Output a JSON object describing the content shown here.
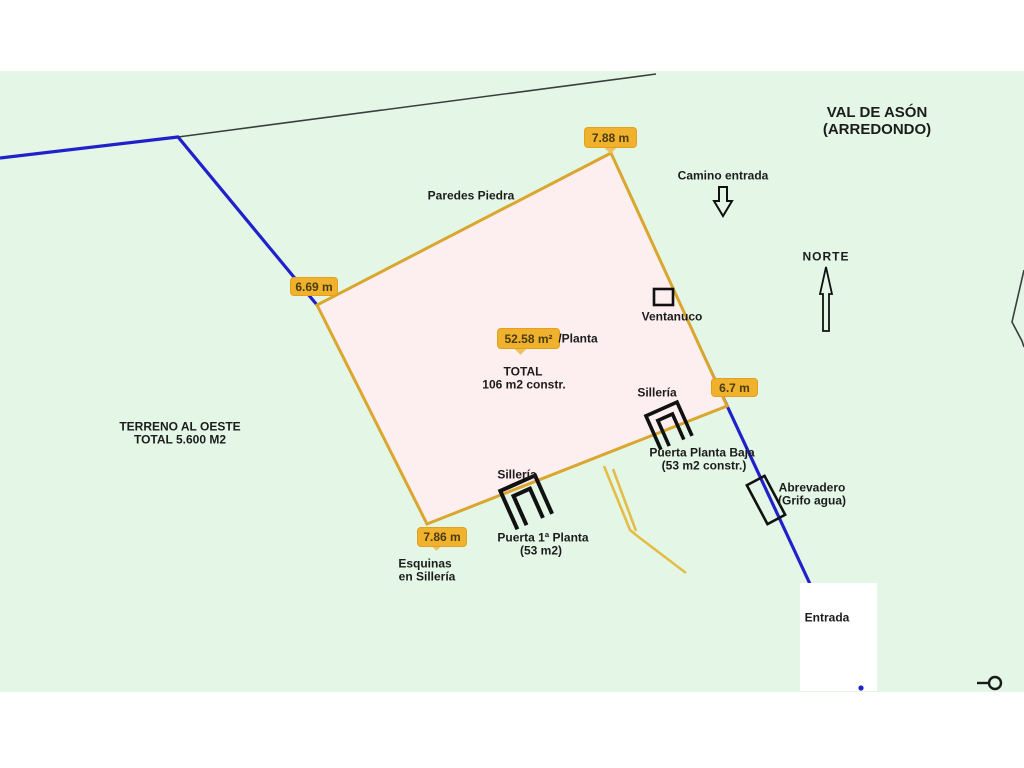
{
  "title": {
    "line1": "VAL DE ASÓN",
    "line2": "(ARREDONDO)"
  },
  "measurements": {
    "top_corner": "7.88 m",
    "left_corner": "6.69 m",
    "right_corner": "6.7 m",
    "bottom_corner": "7.86 m",
    "area_per_floor": "52.58 m²",
    "area_suffix": "/Planta"
  },
  "labels": {
    "paredes_piedra": "Paredes Piedra",
    "camino_entrada": "Camino entrada",
    "norte": "NORTE",
    "ventanuco": "Ventanuco",
    "total_line1": "TOTAL",
    "total_line2": "106 m2 constr.",
    "terreno_line1": "TERRENO AL OESTE",
    "terreno_line2": "TOTAL 5.600 M2",
    "silleria_bottom": "Sillería",
    "silleria_right": "Sillería",
    "puerta_baja_line1": "Puerta Planta Baja",
    "puerta_baja_line2": "(53 m2 constr.)",
    "abrevadero_line1": "Abrevadero",
    "abrevadero_line2": "(Grifo agua)",
    "esquinas_line1": "Esquinas",
    "esquinas_line2": "en Sillería",
    "puerta_1a_line1": "Puerta 1ª Planta",
    "puerta_1a_line2": "(53 m2)",
    "entrada": "Entrada"
  },
  "colors": {
    "canvas_green": "#e4f7e7",
    "parcel_fill": "#fdeef0",
    "parcel_stroke": "#d9a62e",
    "boundary_blue": "#2121cc",
    "badge_fill": "#f0b22c",
    "text": "#1c1c1c"
  }
}
